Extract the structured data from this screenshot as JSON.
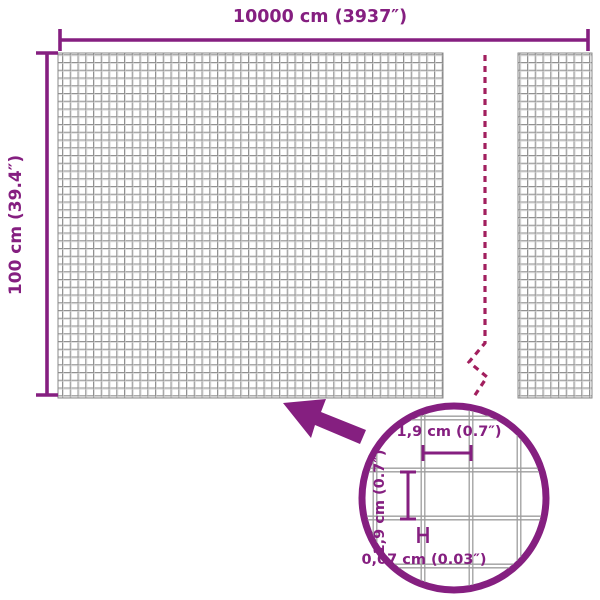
{
  "diagram": {
    "type": "product-dimension-diagram",
    "subject": "wire-mesh-roll",
    "colors": {
      "accent_purple": "#851f80",
      "break_line_maroon": "#a21f5e",
      "mesh_gray": "#898989",
      "detail_wire_gray": "#9e9e9e",
      "background": "#ffffff"
    },
    "overall": {
      "width_label": "10000 cm (3937″)",
      "height_label": "100 cm (39.4″)"
    },
    "detail_view": {
      "cell_width_label": "1,9 cm (0.7″)",
      "cell_height_label": "1,9 cm (0.7″)",
      "wire_thickness_label": "0,07 cm (0.03″)"
    }
  }
}
